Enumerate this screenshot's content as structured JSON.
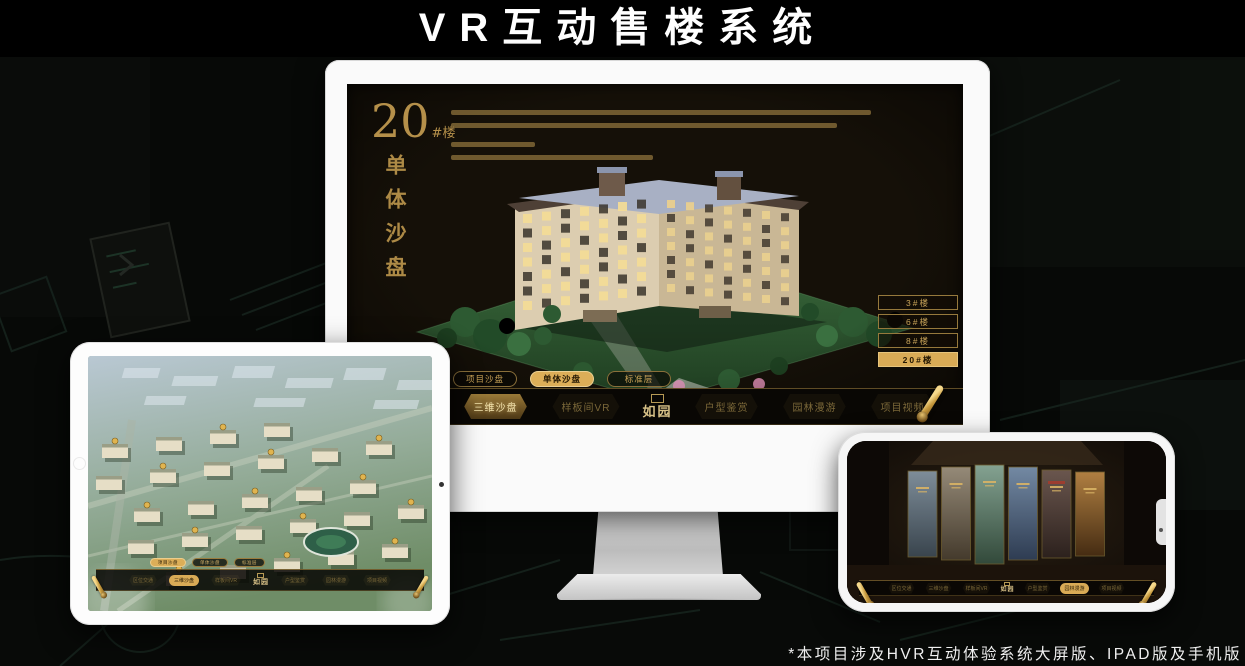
{
  "page": {
    "title": "VR互动售楼系统",
    "footnote": "*本项目涉及HVR互动体验系统大屏版、IPAD版及手机版"
  },
  "colors": {
    "gold": "#c9a45a",
    "gold_active_bg": "#d9ab56",
    "active_text": "#241803",
    "screen_bg": "#151008",
    "menu_text_dim": "#7b6839"
  },
  "desktop": {
    "headline": {
      "number": "20",
      "unit": "#楼",
      "vertical_title": "单体沙盘"
    },
    "floor_buttons": [
      {
        "label": "3#楼",
        "active": false
      },
      {
        "label": "6#楼",
        "active": false
      },
      {
        "label": "8#楼",
        "active": false
      },
      {
        "label": "20#楼",
        "active": true
      }
    ],
    "sub_tabs": [
      {
        "label": "项目沙盘",
        "active": false
      },
      {
        "label": "单体沙盘",
        "active": true
      },
      {
        "label": "标准层",
        "active": false
      }
    ],
    "menu": {
      "logo": "如园",
      "items": [
        {
          "label": "区位交通",
          "active": false
        },
        {
          "label": "三维沙盘",
          "active": true
        },
        {
          "label": "样板间VR",
          "active": false
        },
        {
          "label": "户型鉴赏",
          "active": false
        },
        {
          "label": "园林漫游",
          "active": false
        },
        {
          "label": "项目视频",
          "active": false
        }
      ]
    }
  },
  "tablet": {
    "sub_tabs": [
      {
        "label": "项目沙盘",
        "active": true
      },
      {
        "label": "单体沙盘",
        "active": false
      },
      {
        "label": "标准层",
        "active": false
      }
    ],
    "menu": {
      "logo": "如园",
      "items": [
        {
          "label": "区位交通",
          "active": false
        },
        {
          "label": "三维沙盘",
          "active": true
        },
        {
          "label": "样板间VR",
          "active": false
        },
        {
          "label": "户型鉴赏",
          "active": false
        },
        {
          "label": "园林漫游",
          "active": false
        },
        {
          "label": "项目视频",
          "active": false
        }
      ]
    }
  },
  "phone": {
    "menu": {
      "logo": "如园",
      "items": [
        {
          "label": "区位交通",
          "active": false
        },
        {
          "label": "三维沙盘",
          "active": false
        },
        {
          "label": "样板间VR",
          "active": false
        },
        {
          "label": "户型鉴赏",
          "active": false
        },
        {
          "label": "园林漫游",
          "active": true
        },
        {
          "label": "项目视频",
          "active": false
        }
      ]
    }
  }
}
